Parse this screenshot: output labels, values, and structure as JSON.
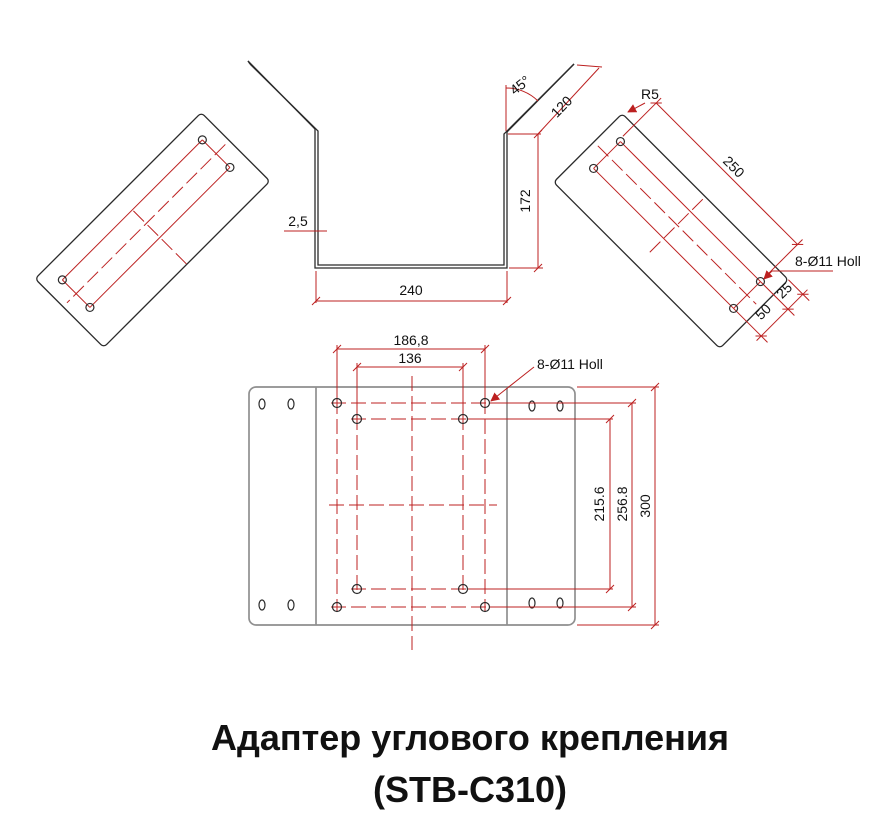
{
  "title": {
    "line1": "Адаптер углового крепления",
    "line2": "(STB-C310)"
  },
  "colors": {
    "background": "#ffffff",
    "outline": "#2b2b2b",
    "plate_outline": "#8f8f8f",
    "dimension": "#bc2020",
    "label": "#111111"
  },
  "views": {
    "profile": {
      "thickness": "2,5",
      "base_width": "240",
      "wall_height": "172",
      "wing_length": "120",
      "wing_angle": "45°"
    },
    "right_plate": {
      "corner_radius": "R5",
      "hole_pitch_length": "250",
      "hole_note": "8-Ø11 Holl",
      "hole_pitch_width": "50",
      "hole_edge_offset": "25"
    },
    "bottom_plate": {
      "outer_hole_pitch_x": "186,8",
      "inner_hole_pitch_x": "136",
      "hole_note": "8-Ø11 Holl",
      "inner_hole_pitch_y": "215.6",
      "outer_hole_pitch_y": "256.8",
      "plate_height": "300"
    }
  }
}
